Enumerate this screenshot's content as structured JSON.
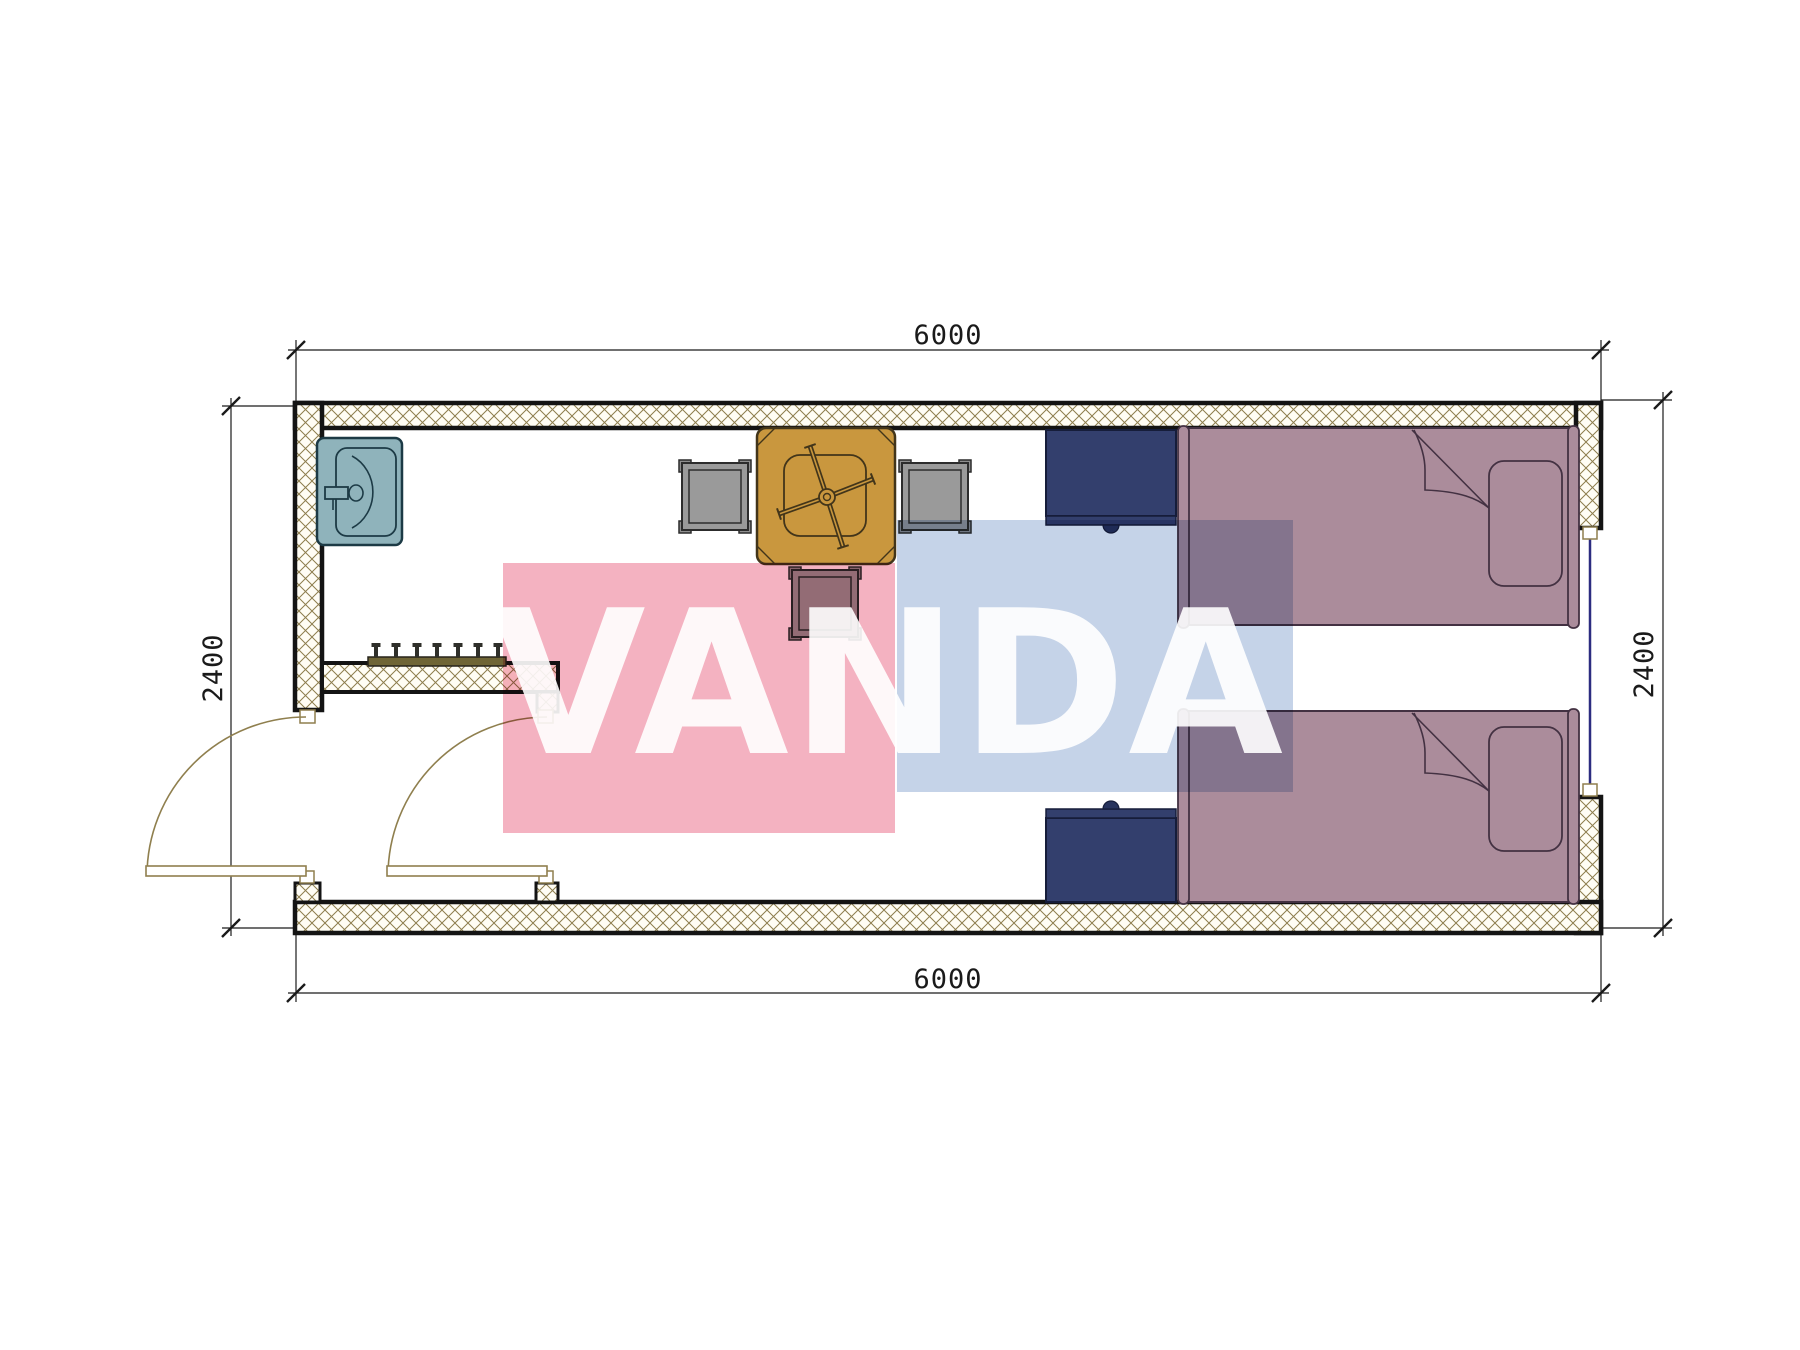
{
  "plan": {
    "type": "container-room-floor-plan",
    "dimensions": {
      "top": "6000",
      "bottom": "6000",
      "left": "2400",
      "right": "2400"
    },
    "watermark": "VANDA",
    "colors": {
      "wall_hatch": "#8d7d4d",
      "wall_outline": "#141414",
      "dimension_line": "#1a1a1a",
      "door_swing": "#8f7f4e",
      "window": "#2c2c80",
      "sink": "#8fb3bb",
      "table": "#c9973e",
      "chair_gray": "#9a9a9a",
      "bed": "#ab8c9b",
      "nightstand": "#333f6d",
      "coat_rack": "#6f6536",
      "watermark_pink": "#f4b2c1",
      "watermark_blue": "#c5d3e8"
    }
  }
}
